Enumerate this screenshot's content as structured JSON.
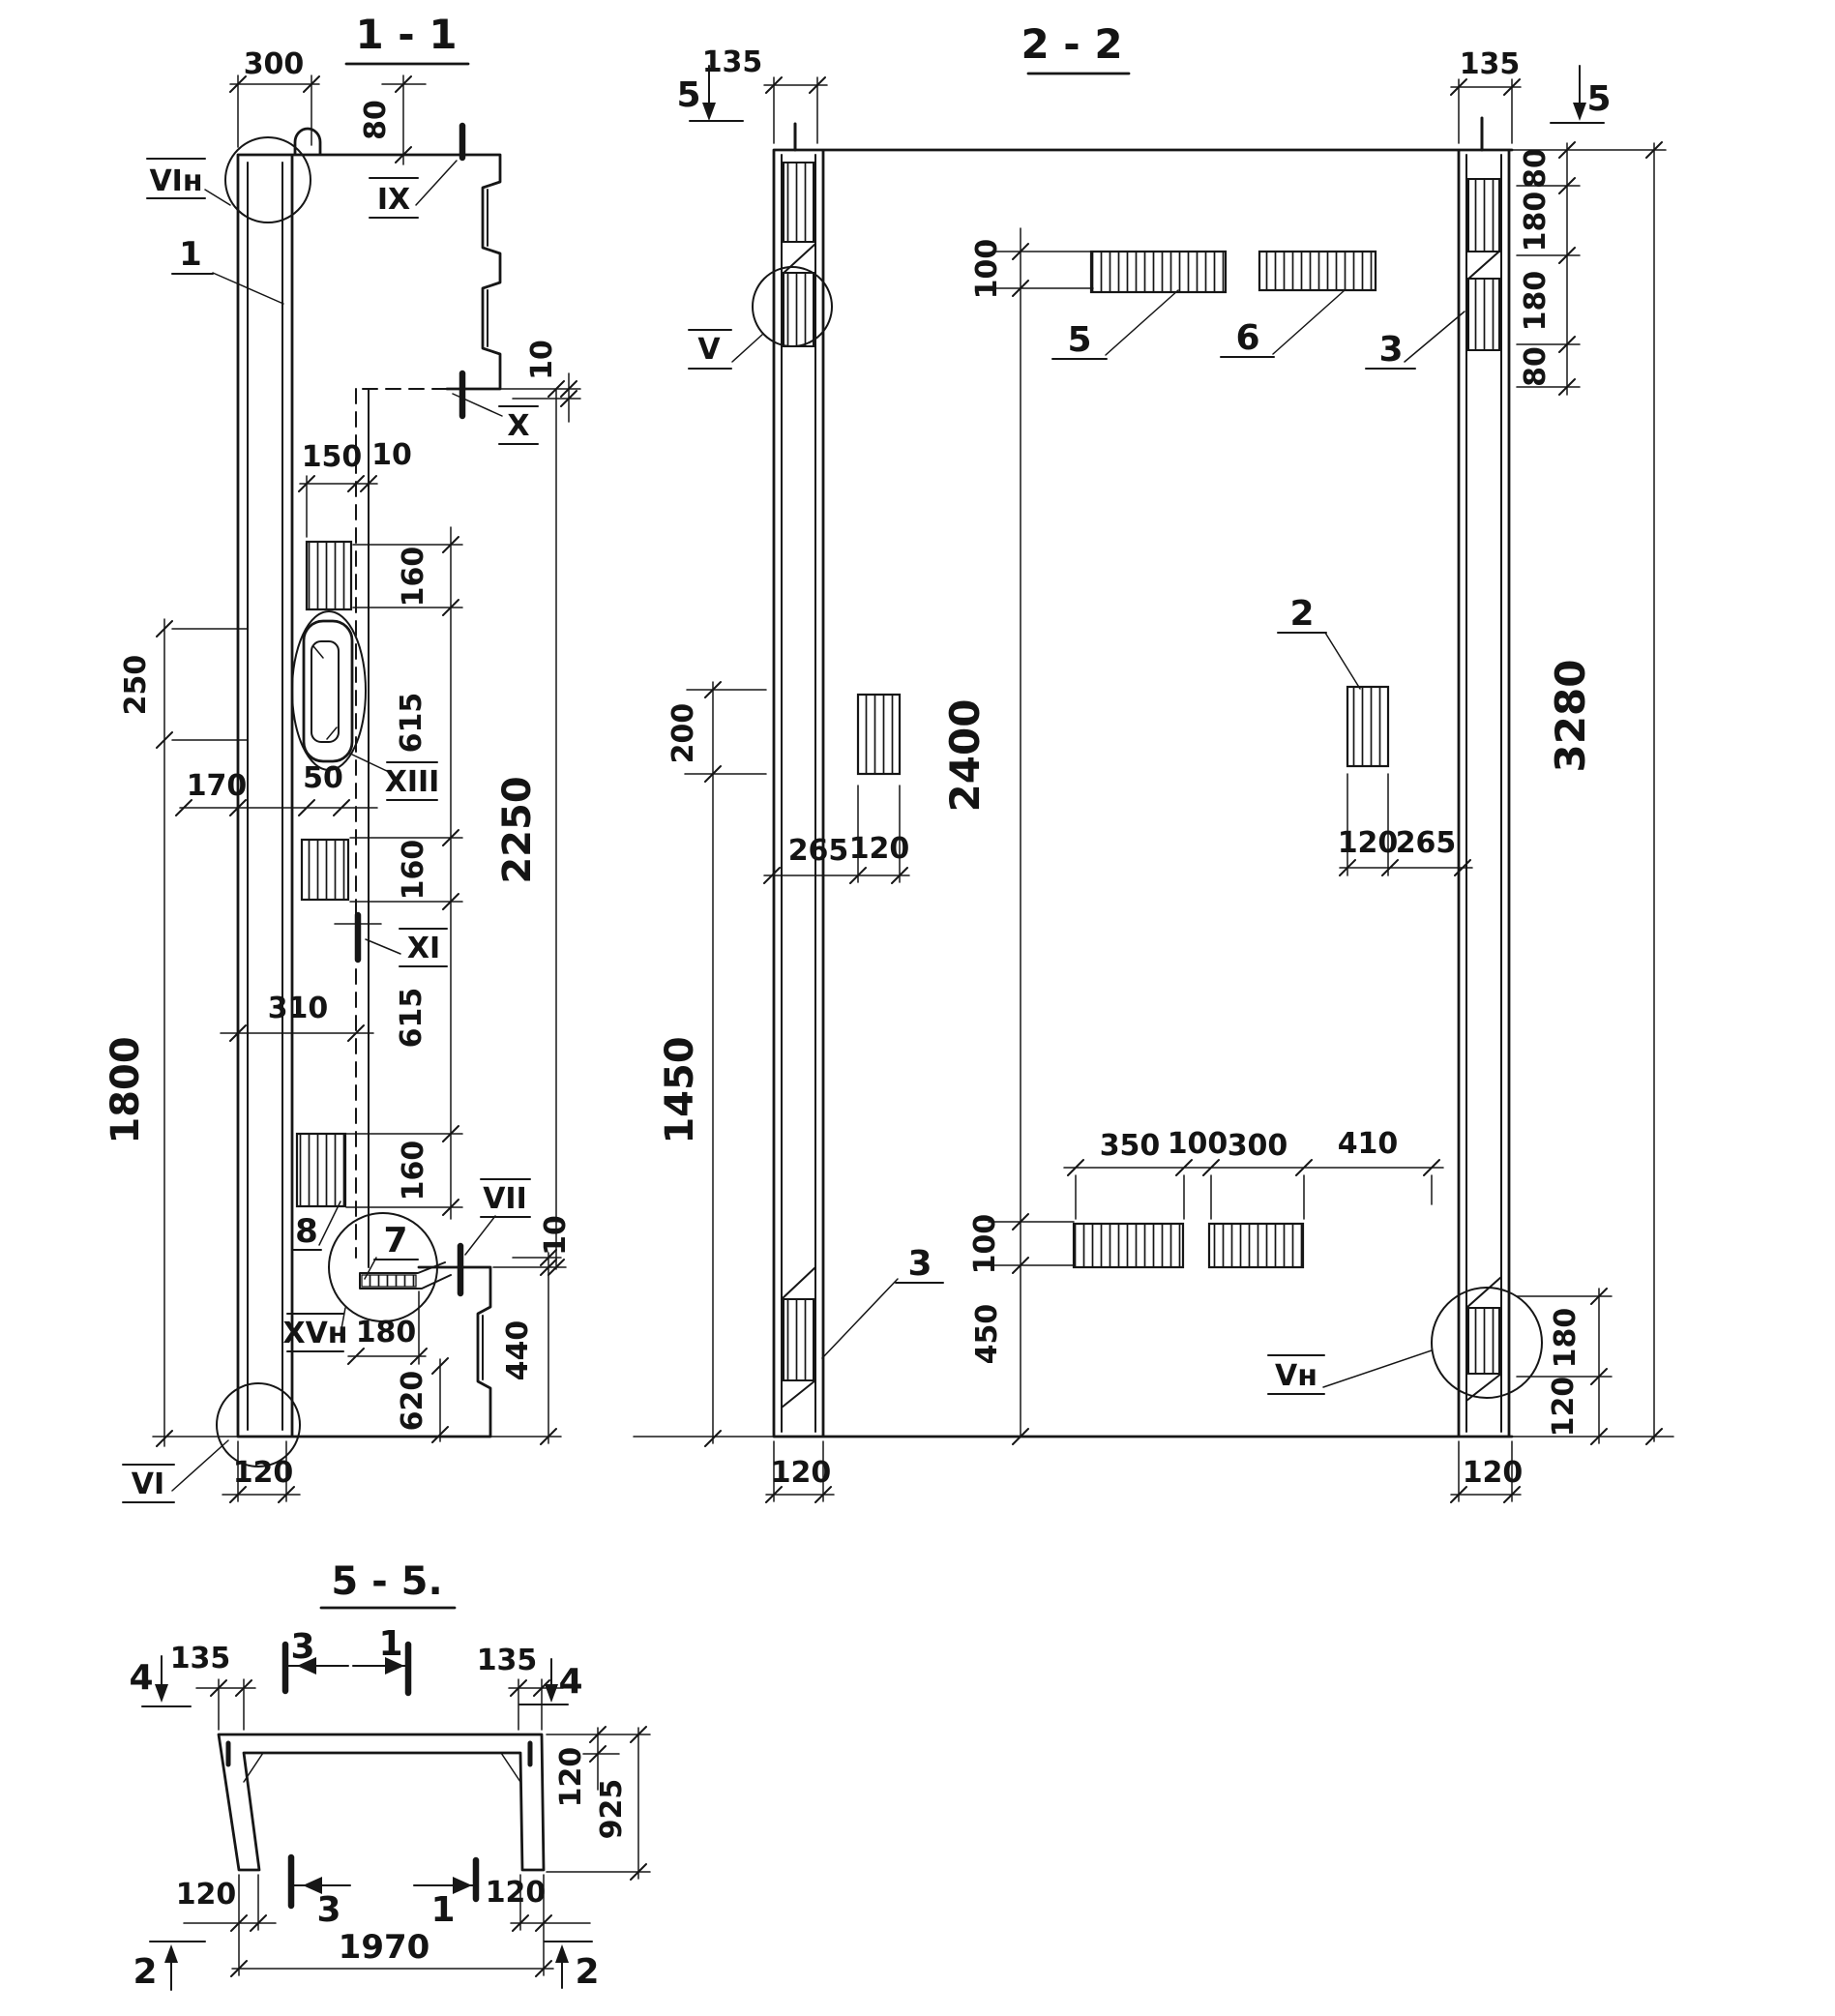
{
  "s11": {
    "title": "1 - 1",
    "dims": {
      "d300": "300",
      "d80": "80",
      "d10a": "10",
      "d150": "150",
      "d10b": "10",
      "d160a": "160",
      "d615a": "615",
      "d160b": "160",
      "d615b": "615",
      "d160c": "160",
      "d2250": "2250",
      "d250": "250",
      "d1800": "1800",
      "d170": "170",
      "d50": "50",
      "d310": "310",
      "d180": "180",
      "d620": "620",
      "d440": "440",
      "d10c": "10",
      "d120": "120"
    },
    "labels": {
      "vi_top": "VIн",
      "ix": "IX",
      "x": "X",
      "xiii": "XIII",
      "xi": "XI",
      "vii": "VII",
      "xv": "XVн",
      "vi": "VI",
      "n1": "1",
      "n7": "7",
      "n8": "8"
    }
  },
  "s22": {
    "title": "2 - 2",
    "dims": {
      "d135l": "135",
      "d135r": "135",
      "d80a": "80",
      "d180a": "180",
      "d180b": "180",
      "d80b": "80",
      "d3280": "3280",
      "d100a": "100",
      "d200": "200",
      "d2400": "2400",
      "d265a": "265",
      "d120a": "120",
      "d120b": "120",
      "d265b": "265",
      "d1450": "1450",
      "d350": "350",
      "d100b": "100",
      "d300": "300",
      "d410": "410",
      "d100c": "100",
      "d450": "450",
      "d180c": "180",
      "d120c": "120",
      "d120d": "120",
      "d120e": "120"
    },
    "labels": {
      "v": "V",
      "vn": "Vн",
      "n2": "2",
      "n3a": "3",
      "n3b": "3",
      "n5": "5",
      "n6": "6",
      "cut5l": "5",
      "cut5r": "5"
    }
  },
  "s55": {
    "title": "5 - 5.",
    "dims": {
      "d135l": "135",
      "d135r": "135",
      "d120a": "120",
      "d925": "925",
      "d120b": "120",
      "d120c": "120",
      "d1970": "1970"
    },
    "labels": {
      "cut4l": "4",
      "cut4r": "4",
      "cut3t": "3",
      "cut1t": "1",
      "cut3b": "3",
      "cut1b": "1",
      "cut2l": "2",
      "cut2r": "2"
    }
  }
}
